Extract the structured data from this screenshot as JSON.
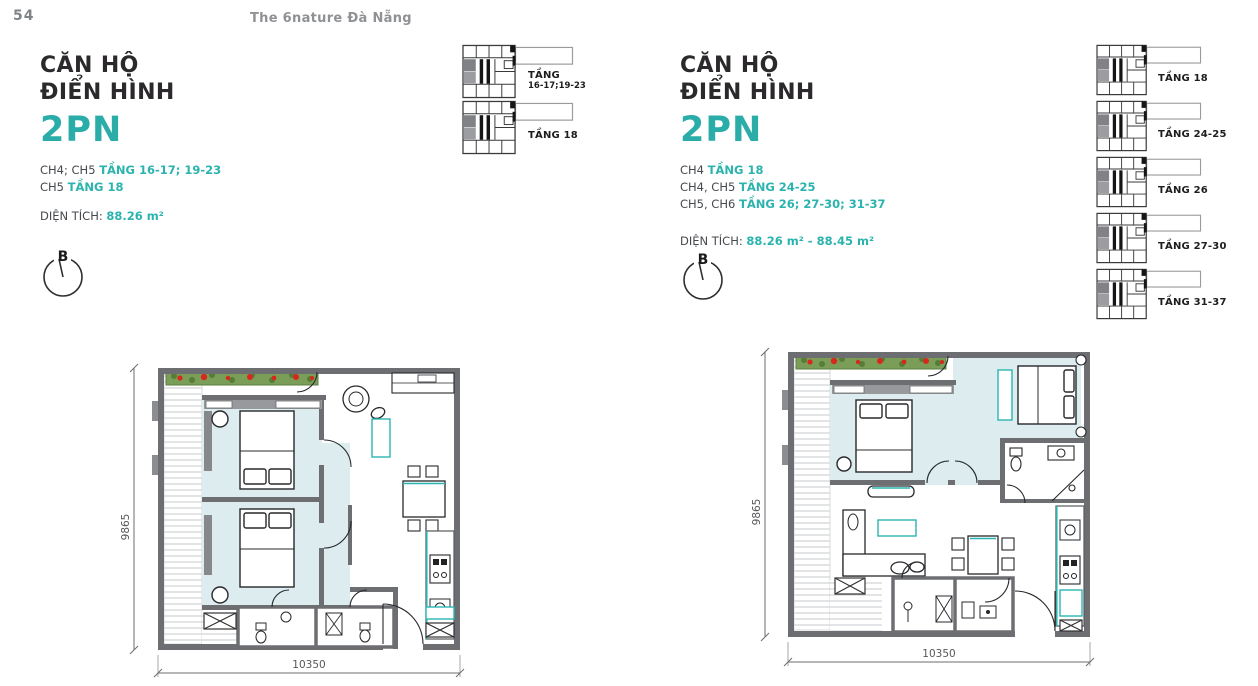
{
  "page": {
    "number": "54",
    "brand": "The 6nature Đà Nẵng"
  },
  "colors": {
    "accent_teal": "#2bb3ae",
    "heading_dark": "#2b292c",
    "wall_gray": "#6d6e71",
    "room_fill": "#dcecef",
    "planter_green": "#7a9e58",
    "flower_red": "#d7281d",
    "muted_gray": "#8f9194"
  },
  "left_section": {
    "title_line1": "CĂN HỘ",
    "title_line2": "ĐIỂN HÌNH",
    "unit_type": "2PN",
    "unit_lines": [
      {
        "units": "CH4; CH5 ",
        "floors": "TẦNG 16-17; 19-23"
      },
      {
        "units": "CH5 ",
        "floors": "TẦNG 18"
      }
    ],
    "area_label": "DIỆN TÍCH: ",
    "area_value": "88.26 m²",
    "compass_letter": "B",
    "keyplans": [
      {
        "line1": "TẦNG",
        "line2": "16-17;19-23"
      },
      {
        "line1": "TẦNG 18",
        "line2": ""
      }
    ],
    "plan": {
      "width_dim": "10350",
      "height_dim": "9865"
    }
  },
  "right_section": {
    "title_line1": "CĂN HỘ",
    "title_line2": "ĐIỂN HÌNH",
    "unit_type": "2PN",
    "unit_lines": [
      {
        "units": "CH4 ",
        "floors": "TẦNG 18"
      },
      {
        "units": "CH4, CH5 ",
        "floors": "TẦNG 24-25"
      },
      {
        "units": "CH5, CH6 ",
        "floors": "TẦNG 26; 27-30; 31-37"
      }
    ],
    "area_label": "DIỆN TÍCH: ",
    "area_value": "88.26 m² - 88.45 m²",
    "compass_letter": "B",
    "keyplans": [
      {
        "line1": "TẦNG 18"
      },
      {
        "line1": "TẦNG 24-25"
      },
      {
        "line1": "TẦNG 26"
      },
      {
        "line1": "TẦNG 27-30"
      },
      {
        "line1": "TẦNG 31-37"
      }
    ],
    "plan": {
      "width_dim": "10350",
      "height_dim": "9865"
    }
  }
}
